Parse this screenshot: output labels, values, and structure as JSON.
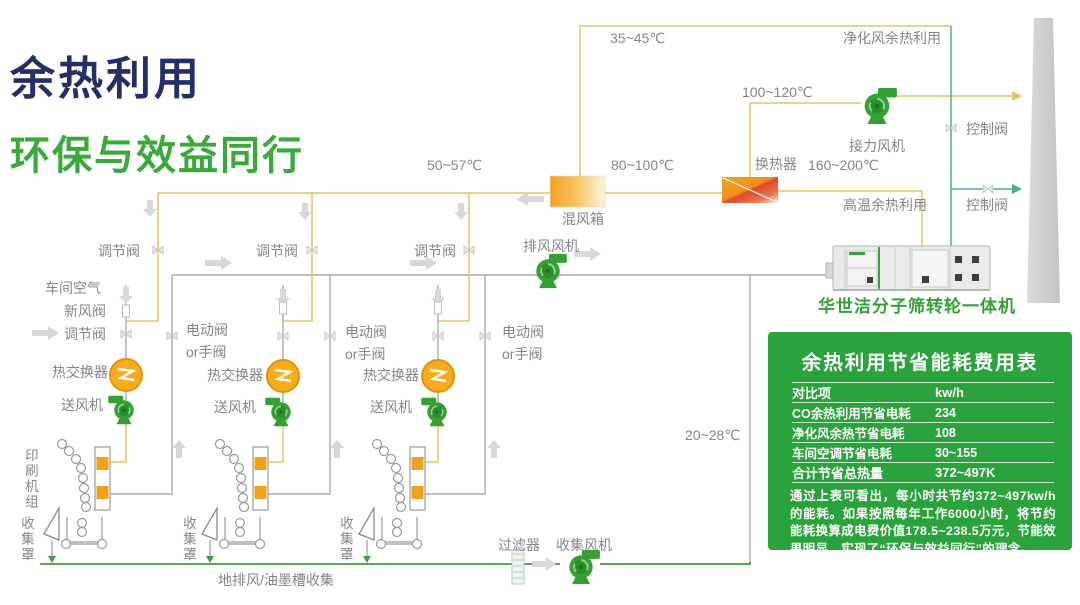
{
  "header": {
    "title_line1": "余热利用",
    "title_line2": "环保与效益同行"
  },
  "diagram": {
    "colors": {
      "line_yellow": "#e3c266",
      "line_grey": "#a9abad",
      "line_teal": "#4fae8e",
      "line_green": "#3f9c3f",
      "orange": "#f2a51f",
      "fan_green": "#35a135",
      "navy": "#242f66",
      "brand_green": "#3aa93c",
      "panel_green": "#2ba33c"
    },
    "labels": {
      "temp_35_45": "35~45℃",
      "purify": "净化风余热利用",
      "temp_100_120": "100~120℃",
      "relay_fan": "接力风机",
      "control_valve": "控制阀",
      "temp_50_57": "50~57℃",
      "temp_80_100": "80~100℃",
      "heat_exchanger": "换热器",
      "temp_160_200": "160~200℃",
      "mix_box": "混风箱",
      "high_temp_use": "高温余热利用",
      "exhaust_fan": "排风风机",
      "regulate_valve": "调节阀",
      "workshop_air": "车间空气",
      "fresh_air_valve": "新风阀",
      "motor_valve": "电动阀\nor手阀",
      "heat_exchanger_unit": "热交换器",
      "supply_fan": "送风机",
      "printing_unit": "印刷机组",
      "collect_hood": "收集罩",
      "temp_20_28": "20~28℃",
      "filter": "过滤器",
      "collect_fan": "收集风机",
      "floor_collect": "地排风/油墨槽收集",
      "machine_name": "华世洁分子筛转轮一体机"
    }
  },
  "panel": {
    "title": "余热利用节省能耗费用表",
    "table": {
      "headers": [
        "对比项",
        "kw/h"
      ],
      "rows": [
        {
          "item": "CO余热利用节省电耗",
          "value": "234"
        },
        {
          "item": "净化风余热节省电耗",
          "value": "108"
        },
        {
          "item": "车间空调节省电耗",
          "value": "30~155"
        },
        {
          "item": "合计节省总热量",
          "value": "372~497K"
        }
      ]
    },
    "note": "通过上表可看出，每小时共节约372~497kw/h的能耗。如果按照每年工作6000小时，将节约能耗换算成电费价值178.5~238.5万元，节能效果明显，实现了“环保与效益同行”的理念。"
  }
}
